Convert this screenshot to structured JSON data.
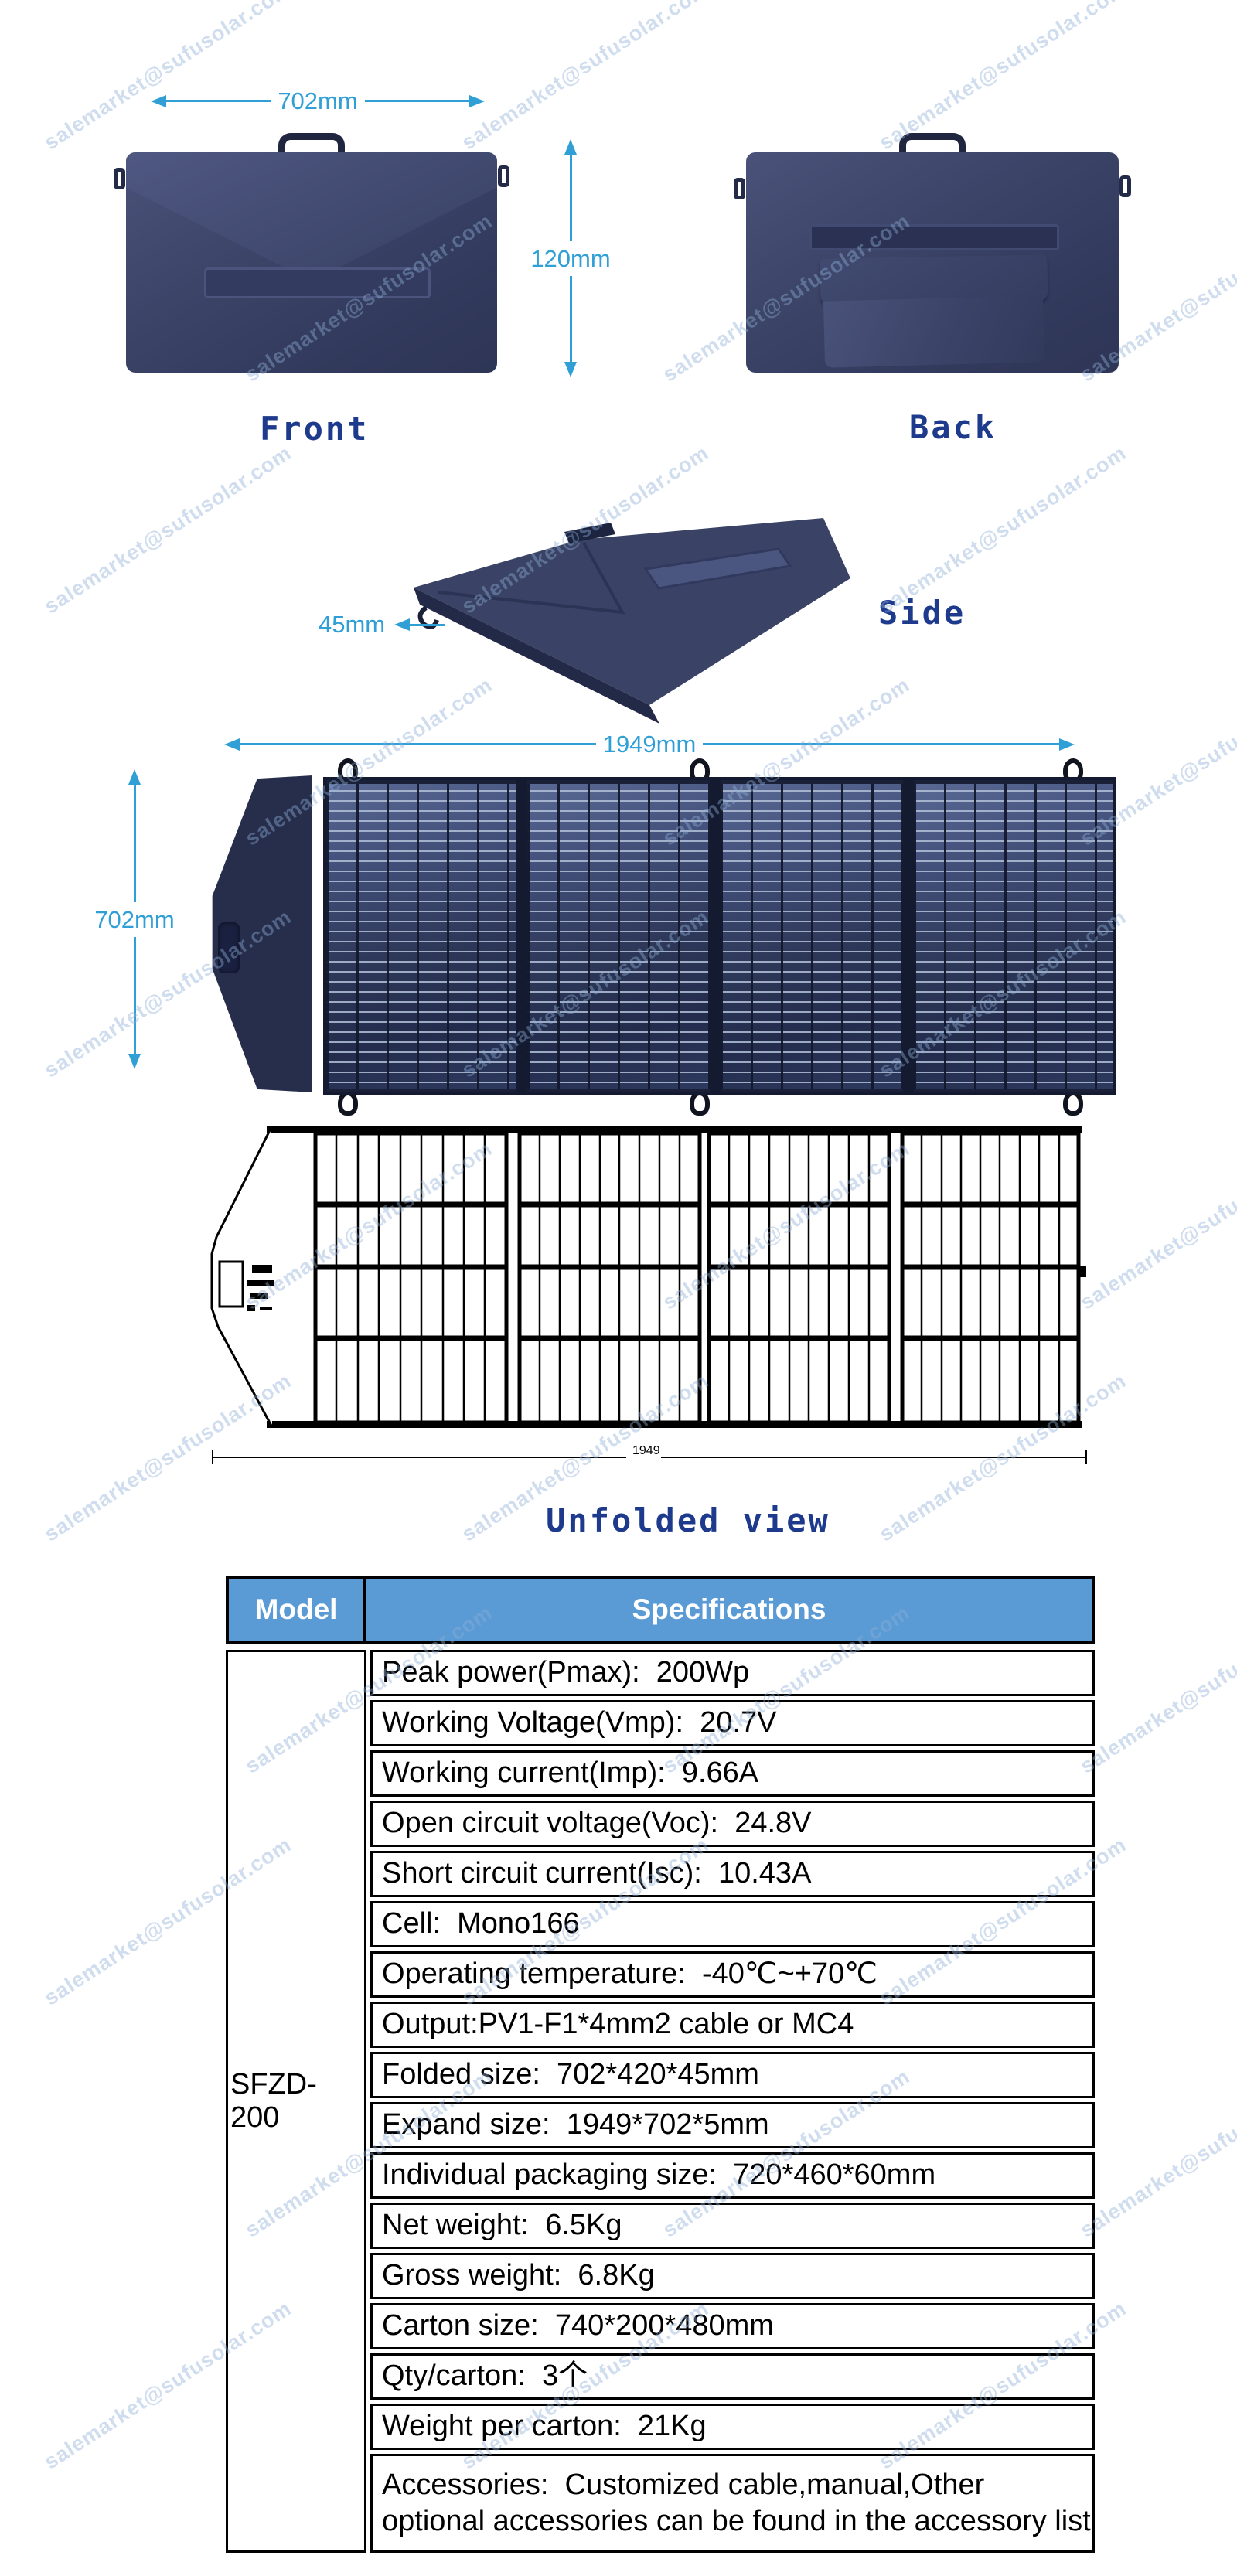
{
  "watermark": {
    "text": "salemarket@sufusolar.com"
  },
  "views": {
    "front": {
      "label": "Front",
      "width_dim": "702mm",
      "height_dim": "120mm"
    },
    "back": {
      "label": "Back"
    },
    "side": {
      "label": "Side",
      "thickness_dim": "45mm"
    },
    "unfolded": {
      "label": "Unfolded view",
      "width_dim": "1949mm",
      "height_dim": "702mm",
      "drawing_dim": "1949"
    }
  },
  "table": {
    "header": {
      "model": "Model",
      "specs": "Specifications"
    },
    "model": "SFZD-200",
    "rows": [
      "Peak power(Pmax):  200Wp",
      "Working Voltage(Vmp):  20.7V",
      "Working current(Imp):  9.66A",
      "Open circuit voltage(Voc):  24.8V",
      "Short circuit current(Isc):  10.43A",
      "Cell:  Mono166",
      "Operating temperature:  -40℃~+70℃",
      "Output:PV1-F1*4mm2 cable or MC4",
      "Folded size:  702*420*45mm",
      "Expand size:  1949*702*5mm",
      "Individual packaging size:  720*460*60mm",
      "Net weight:  6.5Kg",
      "Gross weight:  6.8Kg",
      "Carton size:  740*200*480mm",
      "Qty/carton:  3个",
      "Weight per carton:  21Kg",
      "Accessories:  Customized cable,manual,Other optional accessories can be found in the accessory list"
    ]
  },
  "colors": {
    "header_bg": "#5b9bd5",
    "dimension_cyan": "#2f9fd6",
    "label_navy": "#1e3a8c",
    "bag_navy": "#3c4468",
    "panel_blue": "#2d3758"
  }
}
